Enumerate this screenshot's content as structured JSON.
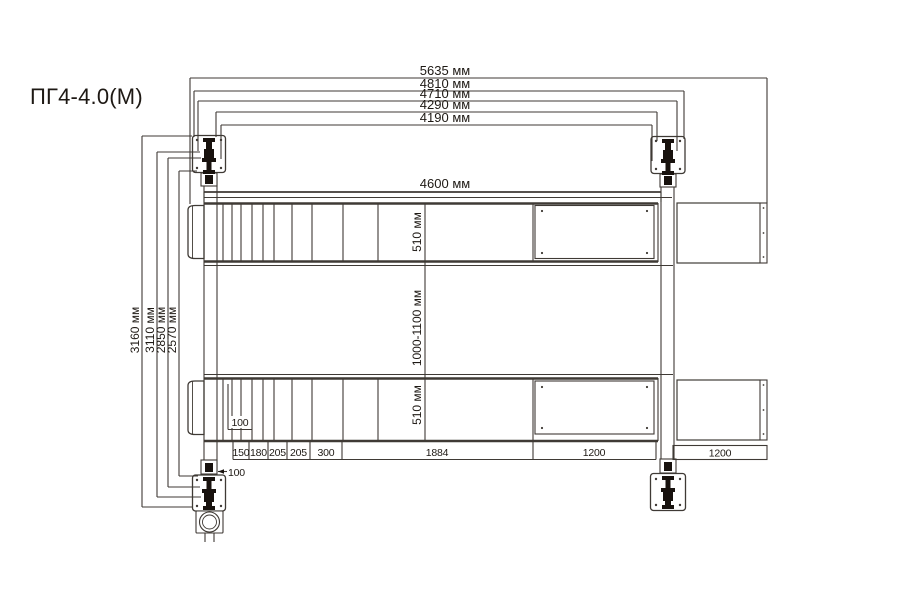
{
  "title": "ПГ4-4.0(М)",
  "colors": {
    "line": "#3f3a35",
    "ink": "#18120e",
    "text": "#1e1914",
    "background": "#ffffff"
  },
  "dimensions": {
    "top": [
      {
        "label": "5635 мм"
      },
      {
        "label": "4810 мм"
      },
      {
        "label": "4710 мм"
      },
      {
        "label": "4290 мм"
      },
      {
        "label": "4190 мм"
      }
    ],
    "runway_length": {
      "label": "4600 мм"
    },
    "left": [
      {
        "label": "3160 мм"
      },
      {
        "label": "3110 мм"
      },
      {
        "label": "2850 мм"
      },
      {
        "label": "2570 мм"
      }
    ],
    "center": [
      {
        "label": "510 мм"
      },
      {
        "label": "1000-1100 мм"
      },
      {
        "label": "510 мм"
      }
    ],
    "bottom_cells": [
      "150",
      "180",
      "205",
      "205",
      "300",
      "1884",
      "1200"
    ],
    "ramp_cell": "1200",
    "offset_runway": "100",
    "offset_post": "100"
  }
}
